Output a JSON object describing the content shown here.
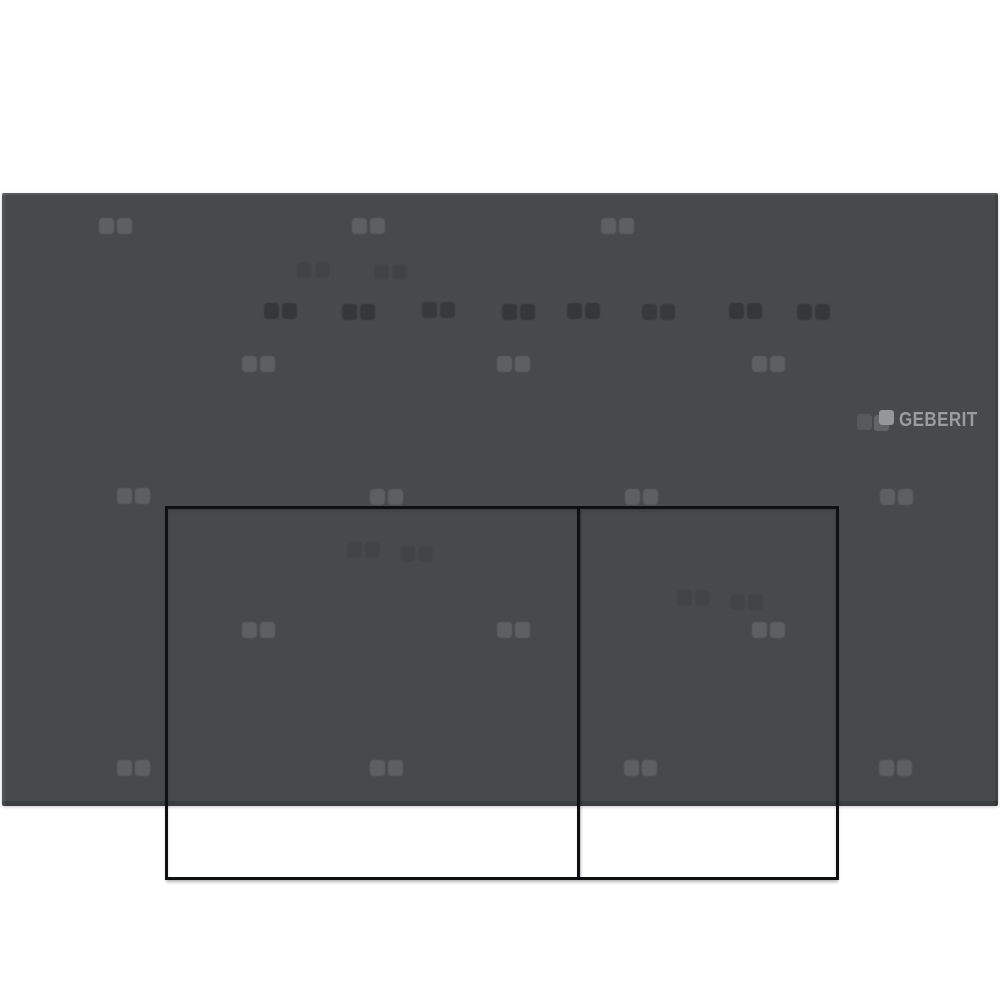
{
  "logo": {
    "wordmark": "GEBERIT"
  },
  "colors": {
    "background": "#ffffff",
    "plate": "#474a4b",
    "button_border": "#0e1011",
    "pattern_light": "#5d6061",
    "pattern_dark": "#242728",
    "logo_text": "#9a9da0",
    "logo_square": "#94979a",
    "logo_pattern_square_1": "#575a5b",
    "logo_pattern_square_2": "#626566"
  },
  "pattern": {
    "light_pairs": [
      [
        97,
        218
      ],
      [
        350,
        218
      ],
      [
        599,
        218
      ],
      [
        240,
        356
      ],
      [
        495,
        356
      ],
      [
        750,
        356
      ],
      [
        115,
        488
      ],
      [
        368,
        489
      ],
      [
        623,
        489
      ],
      [
        878,
        489
      ],
      [
        240,
        622
      ],
      [
        495,
        622
      ],
      [
        750,
        622
      ],
      [
        115,
        760
      ],
      [
        368,
        760
      ],
      [
        622,
        760
      ],
      [
        877,
        760
      ]
    ],
    "dark_pairs": [
      [
        262,
        303,
        0.5
      ],
      [
        340,
        304,
        0.5
      ],
      [
        420,
        302,
        0.45
      ],
      [
        500,
        304,
        0.5
      ],
      [
        565,
        303,
        0.5
      ],
      [
        640,
        304,
        0.45
      ],
      [
        727,
        303,
        0.5
      ],
      [
        795,
        304,
        0.5
      ],
      [
        295,
        262,
        0.15
      ],
      [
        372,
        264,
        0.15
      ],
      [
        345,
        542,
        0.15
      ],
      [
        398,
        546,
        0.15
      ],
      [
        675,
        590,
        0.15
      ],
      [
        728,
        594,
        0.15
      ]
    ]
  }
}
